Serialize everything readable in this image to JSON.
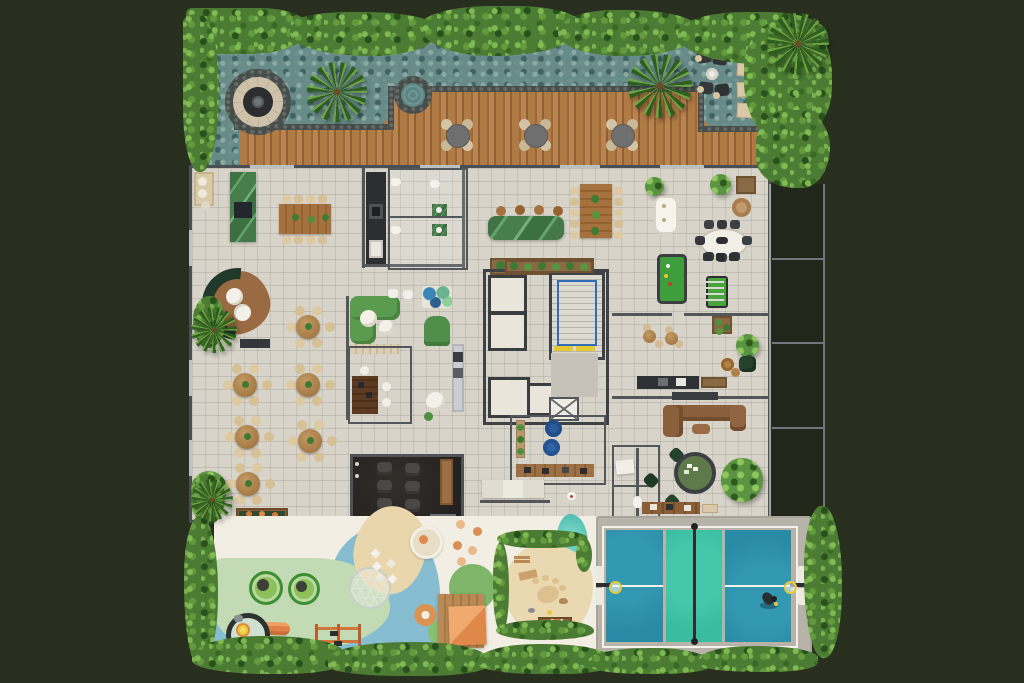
{
  "scene": {
    "type": "architectural floor plan render",
    "view": "top-down",
    "description": "Amenity level of a residential building with roof terrace water garden, fire-pit lounge, outdoor dining deck, indoor dining and lounges, elevator core with stair, games room, cinema room, kids playground, pet park and pickleball/basketball court"
  },
  "palette": {
    "background": "#292f1f",
    "hedge_green": "#4c7c33",
    "gravel_teal": "#678b88",
    "deck_wood": "#a8754a",
    "interior_floor": "#d8d4ca",
    "wall_grey": "#54575a",
    "marble_green": "#477e4c",
    "court_blue": "#2a8ba6",
    "court_teal": "#39bda0",
    "play_blue": "#86bdd0",
    "play_green": "#c3dbb4",
    "sand": "#e9d6ad",
    "play_cream": "#f2eee3",
    "accent_orange": "#e08148",
    "pool_felt": "#3f9e3c",
    "sofa_green": "#5b9b50",
    "sofa_brown": "#8a5f3c",
    "stair_rail_blue": "#2f6db8",
    "bean_bag_blue": "#2a5b9e",
    "safety_yellow": "#e3c92f",
    "fire_pit_stone": "#cfc2aa"
  },
  "regions": [
    {
      "name": "roof-terrace",
      "features": [
        "gravel water garden",
        "stone fire-pit circle",
        "spa circle",
        "palms",
        "hedge border"
      ]
    },
    {
      "name": "outdoor-dining-deck",
      "features": [
        "3 round tables with 4 chairs each",
        "sun lounger corner",
        "stepping mats"
      ]
    },
    {
      "name": "dining-room",
      "features": [
        "6 round tables with wicker chairs",
        "long communal table",
        "green marble bar",
        "lounge with curved dark-green sofa"
      ]
    },
    {
      "name": "kitchen-and-restrooms",
      "features": [
        "dark galley kitchen",
        "two WC stalls with green vanities",
        "green marble island with 4 stools"
      ]
    },
    {
      "name": "core",
      "features": [
        "4 elevators",
        "stairwell with blue railing and yellow safety strip",
        "service shaft"
      ]
    },
    {
      "name": "games-room",
      "features": [
        "pool table",
        "foosball table",
        "oval dining table",
        "white games table",
        "long table with 10 chairs"
      ]
    },
    {
      "name": "tv-lounge",
      "features": [
        "brown sectional sofa",
        "kitchenette counter",
        "cafe tables",
        "card table with 4 green chairs"
      ]
    },
    {
      "name": "cinema-room",
      "features": [
        "6 recliner seats",
        "snack shelf"
      ]
    },
    {
      "name": "craft-room",
      "features": [
        "work desk",
        "2 blue bean bags",
        "plant shelf"
      ]
    },
    {
      "name": "kids-playground",
      "features": [
        "2 trampolines",
        "carousel with slide",
        "climbing frame",
        "geodesic dome",
        "playhouse with deck",
        "donut ring",
        "stepping dots"
      ]
    },
    {
      "name": "pet-park",
      "features": [
        "sand surface",
        "paw print",
        "dog bench",
        "splash pond",
        "hedge enclosure"
      ]
    },
    {
      "name": "sports-court",
      "features": [
        "pickleball court",
        "net",
        "2 basketball hoops",
        "player figure"
      ]
    },
    {
      "name": "balconies",
      "features": [
        "4 dark balcony bays along right edge"
      ]
    }
  ],
  "counts": {
    "deck_tables": 3,
    "round_dining_tables": 6,
    "elevators": 4,
    "cinema_recliners": 6,
    "trampolines": 2,
    "basketball_hoops": 2,
    "pool_tables": 1,
    "foosball_tables": 1,
    "bean_bags": 2,
    "card_tables": 1,
    "palm_trees": 5,
    "sun_loungers": 4,
    "bar_stools": 4
  }
}
